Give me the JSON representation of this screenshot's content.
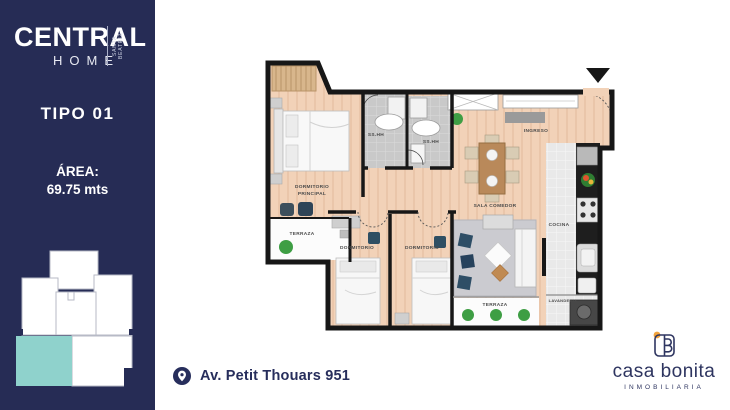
{
  "sidebar": {
    "brand": {
      "name": "CENTRAL",
      "sub": "HOME",
      "tagline": "SANTA BEATRIZ"
    },
    "type_label": "TIPO 01",
    "area_label": "ÁREA:",
    "area_value": "69.75 mts",
    "colors": {
      "bg": "#262c55",
      "unit_highlight": "#8fd2cc"
    }
  },
  "plan": {
    "rooms": {
      "dormitorio_principal_line1": "DORMITORIO",
      "dormitorio_principal_line2": "PRINCIPAL",
      "terraza_left": "TERRAZA",
      "ss_hh_1": "SS.HH",
      "ss_hh_2": "SS.HH",
      "ingreso": "INGRESO",
      "sala_comedor": "SALA COMEDOR",
      "cocina": "COCINA",
      "dormitorio_1": "DORMITORIO",
      "dormitorio_2": "DORMITORIO",
      "terraza_bottom": "TERRAZA",
      "lavanderia": "LAVANDERIA"
    },
    "colors": {
      "wall": "#171717",
      "floor": "#f2d2b8",
      "tile": "#c9c9c9",
      "rug": "#cbcbd0",
      "plant": "#3e9e44",
      "cushion": "#2e4e66"
    }
  },
  "footer": {
    "address": "Av. Petit Thouars 951"
  },
  "agency": {
    "name": "casa bonita",
    "sub": "INMOBILIARIA",
    "colors": {
      "text": "#2e3560",
      "dot": "#f2a33c"
    }
  }
}
